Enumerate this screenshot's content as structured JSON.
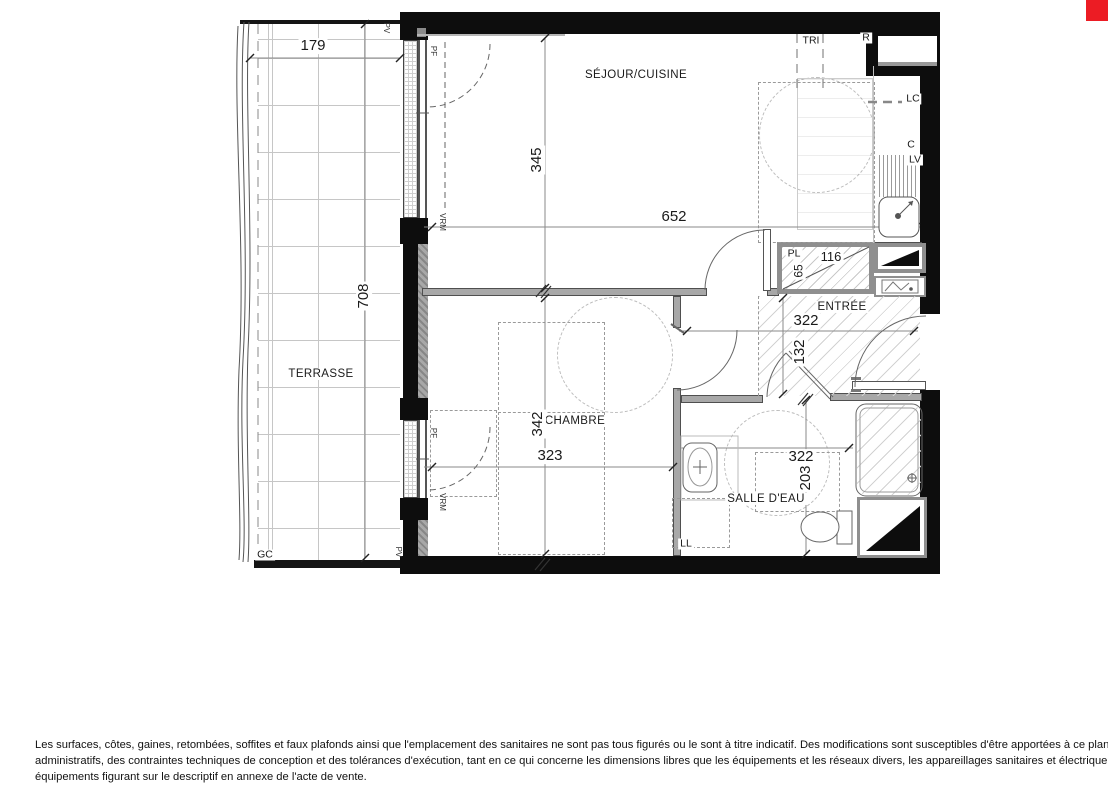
{
  "marker": {
    "color": "#ec1c24"
  },
  "room_labels": [
    {
      "t": "SÉJOUR/CUISINE",
      "x": 636,
      "y": 75
    },
    {
      "t": "TERRASSE",
      "x": 321,
      "y": 374
    },
    {
      "t": "CHAMBRE",
      "x": 575,
      "y": 421
    },
    {
      "t": "SALLE D'EAU",
      "x": 766,
      "y": 499
    },
    {
      "t": "ENTRÉE",
      "x": 842,
      "y": 307
    }
  ],
  "dim_labels": [
    {
      "t": "179",
      "x": 313,
      "y": 46
    },
    {
      "t": "708",
      "x": 364,
      "y": 296,
      "r": -90
    },
    {
      "t": "345",
      "x": 537,
      "y": 160,
      "r": -90
    },
    {
      "t": "652",
      "x": 674,
      "y": 217
    },
    {
      "t": "116",
      "x": 831,
      "y": 257,
      "s": 13
    },
    {
      "t": "65",
      "x": 799,
      "y": 271,
      "r": -90,
      "s": 12
    },
    {
      "t": "322",
      "x": 806,
      "y": 321
    },
    {
      "t": "132",
      "x": 800,
      "y": 352,
      "r": -90
    },
    {
      "t": "342",
      "x": 538,
      "y": 424,
      "r": -90
    },
    {
      "t": "323",
      "x": 550,
      "y": 456
    },
    {
      "t": "322",
      "x": 801,
      "y": 457
    },
    {
      "t": "203",
      "x": 806,
      "y": 478,
      "r": -90
    }
  ],
  "small_labels": [
    {
      "t": "TRI",
      "x": 811,
      "y": 41
    },
    {
      "t": "R",
      "x": 866,
      "y": 38
    },
    {
      "t": "LC",
      "x": 913,
      "y": 99
    },
    {
      "t": "C",
      "x": 911,
      "y": 145
    },
    {
      "t": "LV",
      "x": 915,
      "y": 160
    },
    {
      "t": "PL",
      "x": 794,
      "y": 254
    },
    {
      "t": "LL",
      "x": 686,
      "y": 544
    },
    {
      "t": "GC",
      "x": 265,
      "y": 555
    }
  ],
  "tiny_labels": [
    {
      "t": "PF",
      "x": 433,
      "y": 51,
      "r": 90
    },
    {
      "t": "VRM",
      "x": 442,
      "y": 222,
      "r": 90
    },
    {
      "t": "PF",
      "x": 433,
      "y": 433,
      "r": 90
    },
    {
      "t": "VRM",
      "x": 442,
      "y": 502,
      "r": 90
    },
    {
      "t": "PV",
      "x": 386,
      "y": 28,
      "r": 90
    },
    {
      "t": "PV",
      "x": 398,
      "y": 552,
      "r": 90
    }
  ],
  "disclaimer": {
    "lines": [
      "Les surfaces, côtes, gaines, retombées, soffites et faux plafonds ainsi que l'emplacement des sanitaires ne sont pas tous figurés ou le sont à titre indicatif. Des modifications sont susceptibles d'être apportées à ce plan en fonction des impératifs",
      "administratifs, des contraintes techniques de conception et des tolérances d'exécution, tant en ce qui concerne les dimensions libres que les équipements et les réseaux divers, les appareillages sanitaires et électrique. seuls seront fournis les",
      "équipements figurant sur le descriptif en annexe de l'acte de vente."
    ]
  }
}
